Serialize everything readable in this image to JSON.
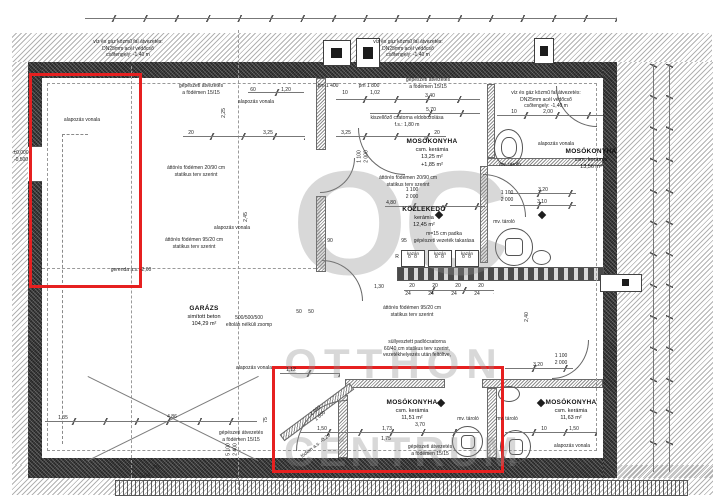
{
  "watermark": {
    "monogram": "OC",
    "line1": "OTTHON",
    "line2": "CENTRUM"
  },
  "rooms": [
    {
      "name": "MOSÓKONYHA",
      "material": "csm. kerámia",
      "area": "13,25 m²",
      "extra": "+1,85 m²",
      "x": 432,
      "y": 138
    },
    {
      "name": "MOSÓKONYHA",
      "material": "csm. kerámia",
      "area": "13,56 m²",
      "extra": "",
      "x": 591,
      "y": 148
    },
    {
      "name": "KÖZLEKEDŐ",
      "material": "kerámia",
      "area": "12,45 m²",
      "extra": "",
      "x": 424,
      "y": 206
    },
    {
      "name": "GARÁZS",
      "material": "simított beton",
      "area": "104,29 m²",
      "extra": "",
      "x": 204,
      "y": 305
    },
    {
      "name": "MOSÓKONYHA",
      "material": "csm. kerámia",
      "area": "11,51 m²",
      "extra": "",
      "x": 412,
      "y": 399
    },
    {
      "name": "MOSÓKONYHA",
      "material": "csm. kerámia",
      "area": "11,63 m²",
      "extra": "",
      "x": 571,
      "y": 399
    }
  ],
  "annotations": [
    {
      "lines": [
        "víz és gáz közmű fal átvezetés:",
        "DN25mm acél védőcső",
        "csőtengely: -1,40 m"
      ],
      "x": 128,
      "y": 39
    },
    {
      "lines": [
        "víz és gáz közmű fal átvezetés:",
        "DN25mm acél védőcső",
        "csőtengely: -1,40 m"
      ],
      "x": 408,
      "y": 39
    },
    {
      "lines": [
        "víz és gáz közmű fal átvezetés:",
        "DN25mm acél védőcső",
        "csőtengely: -1,40 m"
      ],
      "x": 546,
      "y": 90
    },
    {
      "lines": [
        "gépészeti átvezetés",
        "a födémen 15/15"
      ],
      "x": 201,
      "y": 83
    },
    {
      "lines": [
        "gépészeti átvezetés",
        "a födémen 15/15"
      ],
      "x": 428,
      "y": 77
    },
    {
      "lines": [
        "gépészeti átvezetés",
        "a födémen 15/15"
      ],
      "x": 241,
      "y": 430
    },
    {
      "lines": [
        "gépészeti átvezetés",
        "a födémen 15/15"
      ],
      "x": 430,
      "y": 444
    },
    {
      "lines": [
        "alapozás vonala"
      ],
      "x": 82,
      "y": 117
    },
    {
      "lines": [
        "alapozás vonala"
      ],
      "x": 256,
      "y": 99
    },
    {
      "lines": [
        "alapozás vonala"
      ],
      "x": 556,
      "y": 141
    },
    {
      "lines": [
        "alapozás vonala"
      ],
      "x": 232,
      "y": 225
    },
    {
      "lines": [
        "alapozás vonala"
      ],
      "x": 254,
      "y": 365
    },
    {
      "lines": [
        "alapozás vonala"
      ],
      "x": 572,
      "y": 443
    },
    {
      "lines": [
        "áttörés födémen 20/90 cm",
        "statikus terv szerint"
      ],
      "x": 196,
      "y": 165
    },
    {
      "lines": [
        "áttörés födémen 20/90 cm",
        "statikus terv szerint"
      ],
      "x": 408,
      "y": 175
    },
    {
      "lines": [
        "áttörés födémen 95/20 cm",
        "statikus terv szerint"
      ],
      "x": 194,
      "y": 237
    },
    {
      "lines": [
        "áttörés födémen 95/20 cm",
        "statikus terv szerint"
      ],
      "x": 412,
      "y": 305
    },
    {
      "lines": [
        "kiszellőző csatorna eldobozolása",
        "f.s.: 1,80 m"
      ],
      "x": 407,
      "y": 115
    },
    {
      "lines": [
        "m=15 cm padka",
        "gépészeti vezeték takarása"
      ],
      "x": 444,
      "y": 231
    },
    {
      "lines": [
        "süllyesztett padlócsatorna",
        "60/40 cm statikus terv szerint,",
        "vezetékhelyezés után feltöltve,"
      ],
      "x": 417,
      "y": 339
    },
    {
      "lines": [
        "gerenda a.s. -2,60"
      ],
      "x": 131,
      "y": 267
    },
    {
      "lines": [
        "500/500/500",
        "eltolás nélküli zsomp"
      ],
      "x": 249,
      "y": 315
    },
    {
      "lines": [
        "mv. tároló"
      ],
      "x": 510,
      "y": 162
    },
    {
      "lines": [
        "mv. tároló"
      ],
      "x": 504,
      "y": 219
    },
    {
      "lines": [
        "mv. tároló"
      ],
      "x": 468,
      "y": 416
    },
    {
      "lines": [
        "mv. tároló"
      ],
      "x": 507,
      "y": 416
    },
    {
      "lines": [
        "födém a.s. -0,20"
      ],
      "x": 316,
      "y": 443,
      "rot": -38
    },
    {
      "lines": [
        "±0,000",
        "-0,500"
      ],
      "x": 21,
      "y": 150
    },
    {
      "lines": [
        "2%"
      ],
      "x": 156,
      "y": 465
    },
    {
      "lines": [
        "pm 1 400"
      ],
      "x": 328,
      "y": 83
    },
    {
      "lines": [
        "pm 1 800"
      ],
      "x": 369,
      "y": 83
    },
    {
      "lines": [
        "1 100",
        "2 000"
      ],
      "x": 507,
      "y": 190
    },
    {
      "lines": [
        "1 100",
        "2 000"
      ],
      "x": 412,
      "y": 187
    },
    {
      "lines": [
        "1 100",
        "2 000"
      ],
      "x": 363,
      "y": 150,
      "rot": -90
    },
    {
      "lines": [
        "1 100",
        "2 000"
      ],
      "x": 561,
      "y": 353
    },
    {
      "lines": [
        "5 100",
        "2 400"
      ],
      "x": 232,
      "y": 443,
      "rot": -90
    },
    {
      "lines": [
        "2 000",
        "1 800"
      ],
      "x": 318,
      "y": 407,
      "rot": -40
    },
    {
      "lines": [
        "R"
      ],
      "x": 397,
      "y": 254
    }
  ],
  "dims": [
    {
      "t": "60",
      "x": 253,
      "y": 87
    },
    {
      "t": "1,20",
      "x": 286,
      "y": 87
    },
    {
      "t": "20",
      "x": 191,
      "y": 130
    },
    {
      "t": "3,25",
      "x": 268,
      "y": 130
    },
    {
      "t": "2,25",
      "x": 224,
      "y": 110,
      "rot": -90
    },
    {
      "t": "2,45",
      "x": 246,
      "y": 214,
      "rot": -90
    },
    {
      "t": "10",
      "x": 345,
      "y": 90
    },
    {
      "t": "1,02",
      "x": 375,
      "y": 90
    },
    {
      "t": "3,40",
      "x": 430,
      "y": 93
    },
    {
      "t": "5,70",
      "x": 431,
      "y": 107
    },
    {
      "t": "3,25",
      "x": 346,
      "y": 130
    },
    {
      "t": "20",
      "x": 437,
      "y": 130
    },
    {
      "t": "10",
      "x": 514,
      "y": 109
    },
    {
      "t": "2,00",
      "x": 548,
      "y": 109
    },
    {
      "t": "4,80",
      "x": 391,
      "y": 200
    },
    {
      "t": "90",
      "x": 330,
      "y": 238
    },
    {
      "t": "95",
      "x": 404,
      "y": 238
    },
    {
      "t": "3,20",
      "x": 543,
      "y": 187
    },
    {
      "t": "3,10",
      "x": 542,
      "y": 199
    },
    {
      "t": "2,40",
      "x": 527,
      "y": 314,
      "rot": -90
    },
    {
      "t": "3,20",
      "x": 538,
      "y": 362
    },
    {
      "t": "10",
      "x": 544,
      "y": 426
    },
    {
      "t": "1,50",
      "x": 574,
      "y": 426
    },
    {
      "t": "1,12",
      "x": 291,
      "y": 367
    },
    {
      "t": "75",
      "x": 266,
      "y": 417,
      "rot": -90
    },
    {
      "t": "1,50",
      "x": 322,
      "y": 426
    },
    {
      "t": "1,75",
      "x": 386,
      "y": 436
    },
    {
      "t": "1,73",
      "x": 387,
      "y": 426
    },
    {
      "t": "3,70",
      "x": 420,
      "y": 422
    },
    {
      "t": "1,35",
      "x": 63,
      "y": 415
    },
    {
      "t": "4,86",
      "x": 172,
      "y": 414
    },
    {
      "t": "3,04",
      "x": 145,
      "y": 473
    },
    {
      "t": "1,30",
      "x": 379,
      "y": 284
    },
    {
      "t": "20",
      "x": 412,
      "y": 283
    },
    {
      "t": "20",
      "x": 435,
      "y": 283
    },
    {
      "t": "20",
      "x": 458,
      "y": 283
    },
    {
      "t": "20",
      "x": 481,
      "y": 283
    },
    {
      "t": "24",
      "x": 408,
      "y": 291
    },
    {
      "t": "24",
      "x": 431,
      "y": 291
    },
    {
      "t": "24",
      "x": 454,
      "y": 291
    },
    {
      "t": "24",
      "x": 477,
      "y": 291
    },
    {
      "t": "50",
      "x": 299,
      "y": 309
    },
    {
      "t": "50",
      "x": 311,
      "y": 309
    }
  ],
  "boilers": {
    "label": "kazán",
    "count": 3
  }
}
